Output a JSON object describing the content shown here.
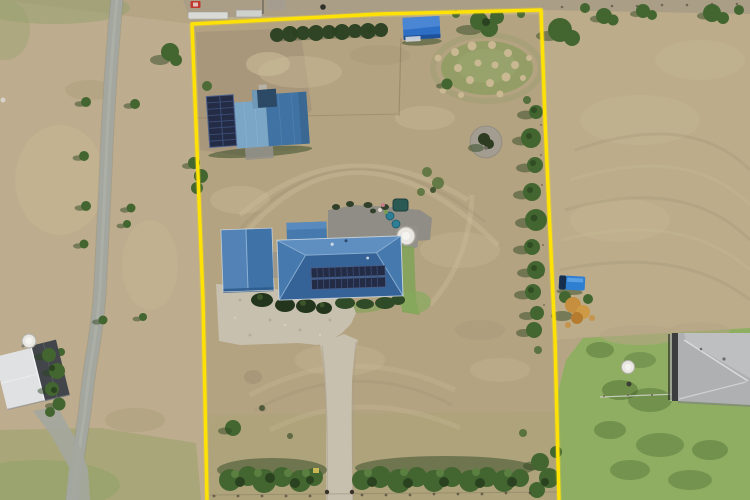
{
  "scene": {
    "description": "Aerial drone photograph of a rural residential property outlined with a yellow boundary overlay: a blue-roofed house with rooftop solar panels, detached garage, gravel driveway, large shed with solar panels, blue tarp shed, tree rows along the fences, a country road to the left and neighbouring houses at the lower corners.",
    "width_px": 750,
    "height_px": 500
  },
  "objects": {
    "boundary": "yellow property boundary outline",
    "main_house": "blue hip-roof house with two rows of solar panels",
    "garage": "detached blue-roof garage",
    "shed": "large shed with solar panel array (top left)",
    "tarp_shed": "small bright-blue shed (top centre)",
    "water_tank": "round white water tank behind house",
    "fire_pit": "round gravel fire-pit circle with small tree",
    "driveway": "gravel driveway from bottom edge to house court",
    "road": "sealed country road on the left",
    "neighbour_house_left": "white/charcoal roof house, bottom left",
    "neighbour_house_right": "grey hip-roof house, bottom right",
    "blue_trailer": "blue trailer parked outside east boundary",
    "autumn_tree": "orange-foliage tree outside east boundary"
  },
  "colors": {
    "boundary": "#ffe205",
    "field_base": "#b5a585",
    "field_left": "#bdac8d",
    "field_right": "#bcac8a",
    "field_top": "#ab9e87",
    "field_light": "#cbbc98",
    "field_dark": "#9c8e71",
    "dirt": "#a5937a",
    "green_tint": "#93a06c",
    "lawn": "#8fae62",
    "tree": "#436630",
    "tree_dark": "#2a4220",
    "tree_light": "#5b7f40",
    "hedge": "#2e4424",
    "road": "#a4a79f",
    "road_edge": "#8f9289",
    "gravel": "#c7c0af",
    "gravel_dark": "#a99f8a",
    "concrete": "#94918a",
    "roof_blue": "#4679ad",
    "roof_blue_light": "#5e8fc0",
    "roof_blue_dark": "#335f95",
    "roof_trim": "#d7dee6",
    "solar": "#232b45",
    "solar_grid": "#3c4f78",
    "shed_mid": "#4073a3",
    "shed_light": "#7ba6c6",
    "shed_dark": "#2c4a66",
    "tarp": "#2e6fc6",
    "tarp_light": "#4f88d6",
    "tarp_dark": "#1d4e95",
    "tank": "#e9e7e1",
    "tank_shade": "#b4b1a8",
    "spa": "#2b5a54",
    "teal": "#2e7f96",
    "trailer": "#2e7ed2",
    "trailer_dark": "#172f4e",
    "autumn": "#c68e3f",
    "nb_gray": "#aeb0b2",
    "nb_gray_light": "#bdbfc1",
    "nb_dark": "#3b3d3f",
    "nb_white": "#dfe1e3",
    "nb_charcoal": "#42464a",
    "mound": "#c9b892",
    "red_car": "#c0392e",
    "white_obj": "#d9dad6"
  }
}
